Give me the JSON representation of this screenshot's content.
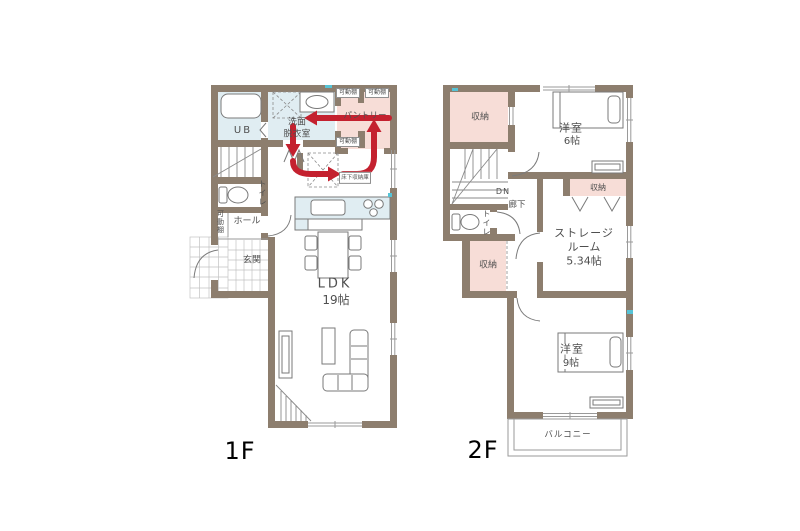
{
  "colors": {
    "wall": "#8d7e6e",
    "room_pink": "#f7ddd7",
    "room_blue": "#e0edf2",
    "arrow_red": "#c4212f",
    "aqua_mark": "#56c3d6"
  },
  "floor1": {
    "floor_label": "1F",
    "unit_bath": "UB",
    "washroom_line1": "洗面",
    "washroom_line2": "脱衣室",
    "pantry": "パントリー",
    "movable_shelf": "可動棚",
    "toilet": "トイレ",
    "hall": "ホール",
    "entrance": "玄関",
    "underfloor_storage": "床下収納庫",
    "ldk_line1": "LDK",
    "ldk_line2": "19帖"
  },
  "floor2": {
    "floor_label": "2F",
    "closet": "収納",
    "bedroom6_line1": "洋室",
    "bedroom6_line2": "6帖",
    "down": "DN",
    "corridor": "廊下",
    "toilet": "トイレ",
    "storage_room_line1": "ストレージ",
    "storage_room_line2": "ルーム",
    "storage_room_line3": "5.34帖",
    "bedroom9_line1": "洋室",
    "bedroom9_line2": "9帖",
    "balcony": "バルコニー"
  }
}
